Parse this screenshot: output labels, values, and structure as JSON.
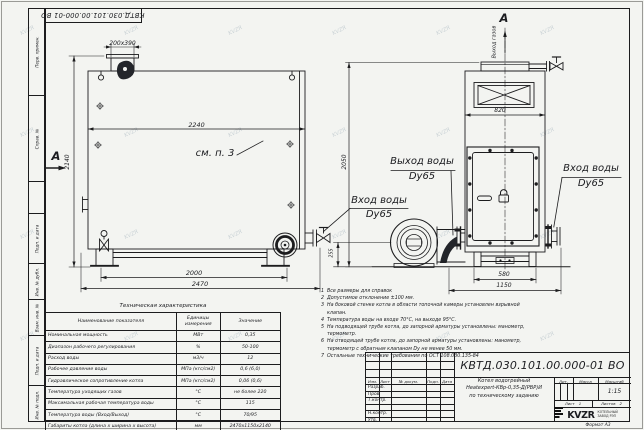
{
  "sheet": {
    "designation": "КВТД.030.101.00.000-01 ВО",
    "format_label": "Формат А3",
    "watermark": "KVZR"
  },
  "margin_labels": [
    "Перв. примен.",
    "Справ. №",
    "Подп. и дата",
    "Инв. № дубл.",
    "Взам. инв. №",
    "Подп. и дата",
    "Инв. № подл."
  ],
  "views": {
    "left": {
      "flue_dim": "200x390",
      "width_dim": "2240",
      "height_dim": "2140",
      "see_note": "см. п. 3",
      "section_letter": "А",
      "base_dim_inner": "2000",
      "base_dim_outer": "2470"
    },
    "right": {
      "section_letter": "А",
      "gas_out": "Выход газов",
      "width_dim": "820",
      "height_dim": "2050",
      "base_height_dim": "255",
      "base_dim_inner": "580",
      "base_dim_outer": "1150"
    }
  },
  "callouts": {
    "water_out_line1": "Выход воды",
    "water_out_line2": "Dy65",
    "water_in_left_line1": "Вход воды",
    "water_in_left_line2": "Dy65",
    "water_in_right_line1": "Вход воды",
    "water_in_right_line2": "Dy65"
  },
  "tech_table": {
    "title": "Техническая характеристика",
    "headers": [
      "Наименование показателя",
      "Единицы измерения",
      "Значение"
    ],
    "rows": [
      [
        "Номинальная мощность",
        "МВт",
        "0,35"
      ],
      [
        "Диапазон рабочего регулирования",
        "%",
        "50-100"
      ],
      [
        "Расход воды",
        "м3/ч",
        "12"
      ],
      [
        "Рабочее давление воды",
        "МПа (кгс/см2)",
        "0,6 (6,0)"
      ],
      [
        "Гидравлическое сопротивление котла",
        "МПа (кгс/см2)",
        "0,06 (0,6)"
      ],
      [
        "Температура уходящих газов",
        "°С",
        "не более 220"
      ],
      [
        "Максимальная рабочая температура воды",
        "°С",
        "115"
      ],
      [
        "Температура воды (Вход/Выход)",
        "°С",
        "70/95"
      ],
      [
        "Габариты котла (длина х ширина х высота)",
        "мм",
        "2470х1150х2140"
      ]
    ]
  },
  "notes": [
    {
      "n": "1",
      "text": "Все размеры для справок"
    },
    {
      "n": "2",
      "text": "Допустимое отклонение ±100 мм."
    },
    {
      "n": "3",
      "text": "На боковой стенке котла в области топочной камеры установлен взрывной клапан."
    },
    {
      "n": "4",
      "text": "Температура воды на входе 70°С, на выходе 95°С."
    },
    {
      "n": "5",
      "text": "На подводящей трубе котла, до запорной арматуры установлены: манометр, термометр."
    },
    {
      "n": "6",
      "text": "На отводящей трубе котла, до запорной арматуры установлены: манометр, термометр с обратным клапаном Dу не менее 50 мм."
    },
    {
      "n": "7",
      "text": "Остальные технические требования по ОСТ 108.030.135-84"
    }
  ],
  "title_block": {
    "header_cols": [
      "Изм.",
      "Лист",
      "№ докум.",
      "Подп.",
      "Дата"
    ],
    "row_labels": [
      "Разраб.",
      "Пров.",
      "Т.контр.",
      "Н.контр.",
      "Утв."
    ],
    "name_line1": "Котел водогрейный",
    "name_line2": "Heatexpert-КВр-0,35-Д(РВР)И",
    "name_line3": "по техническому заданию",
    "lit_label": "Лит.",
    "mass_label": "Масса",
    "scale_label": "Масштаб",
    "scale_value": "1:15",
    "sheet_label": "Лист",
    "sheet_value": "1",
    "sheets_label": "Листов",
    "sheets_value": "2",
    "logo_text": "KVZR",
    "company_line1": "КОТЕЛЬНЫЙ",
    "company_line2": "ЗАВОД РЭП"
  }
}
